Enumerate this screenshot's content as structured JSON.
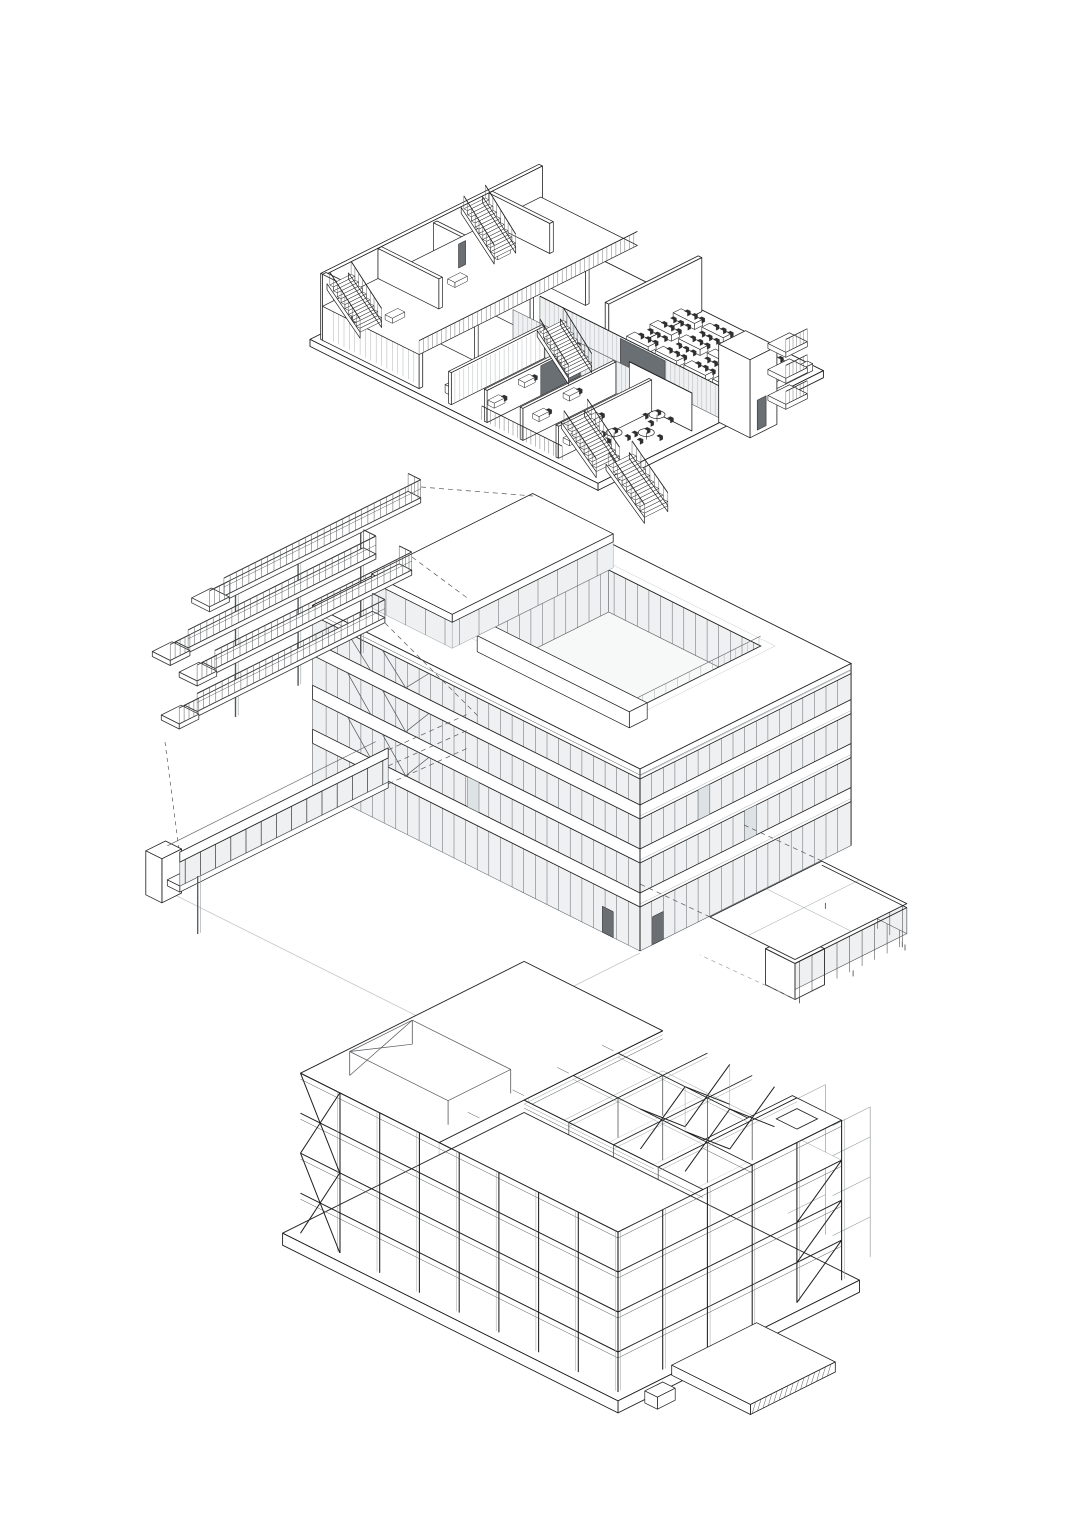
{
  "canvas": {
    "width": 1086,
    "height": 1536,
    "background": "#ffffff"
  },
  "figure": {
    "kind": "architectural-exploded-axonometric-set",
    "colors": {
      "ink": "#1f1f1f",
      "medium": "#54585b",
      "light": "#9aa0a3",
      "faint": "#c6cacc",
      "glass": "#eef0f1",
      "glass_shade": "#dde2e4",
      "panel_dark": "#6a6f73",
      "chair_dark": "#2e2e2e",
      "paper": "#ffffff"
    },
    "drawings": [
      {
        "id": "interior-fitout",
        "name": "interior-fitout-axonometric"
      },
      {
        "id": "facade-envelope",
        "name": "facade-envelope-exploded-axonometric"
      },
      {
        "id": "structural-frame",
        "name": "structural-frame-axonometric"
      }
    ]
  }
}
